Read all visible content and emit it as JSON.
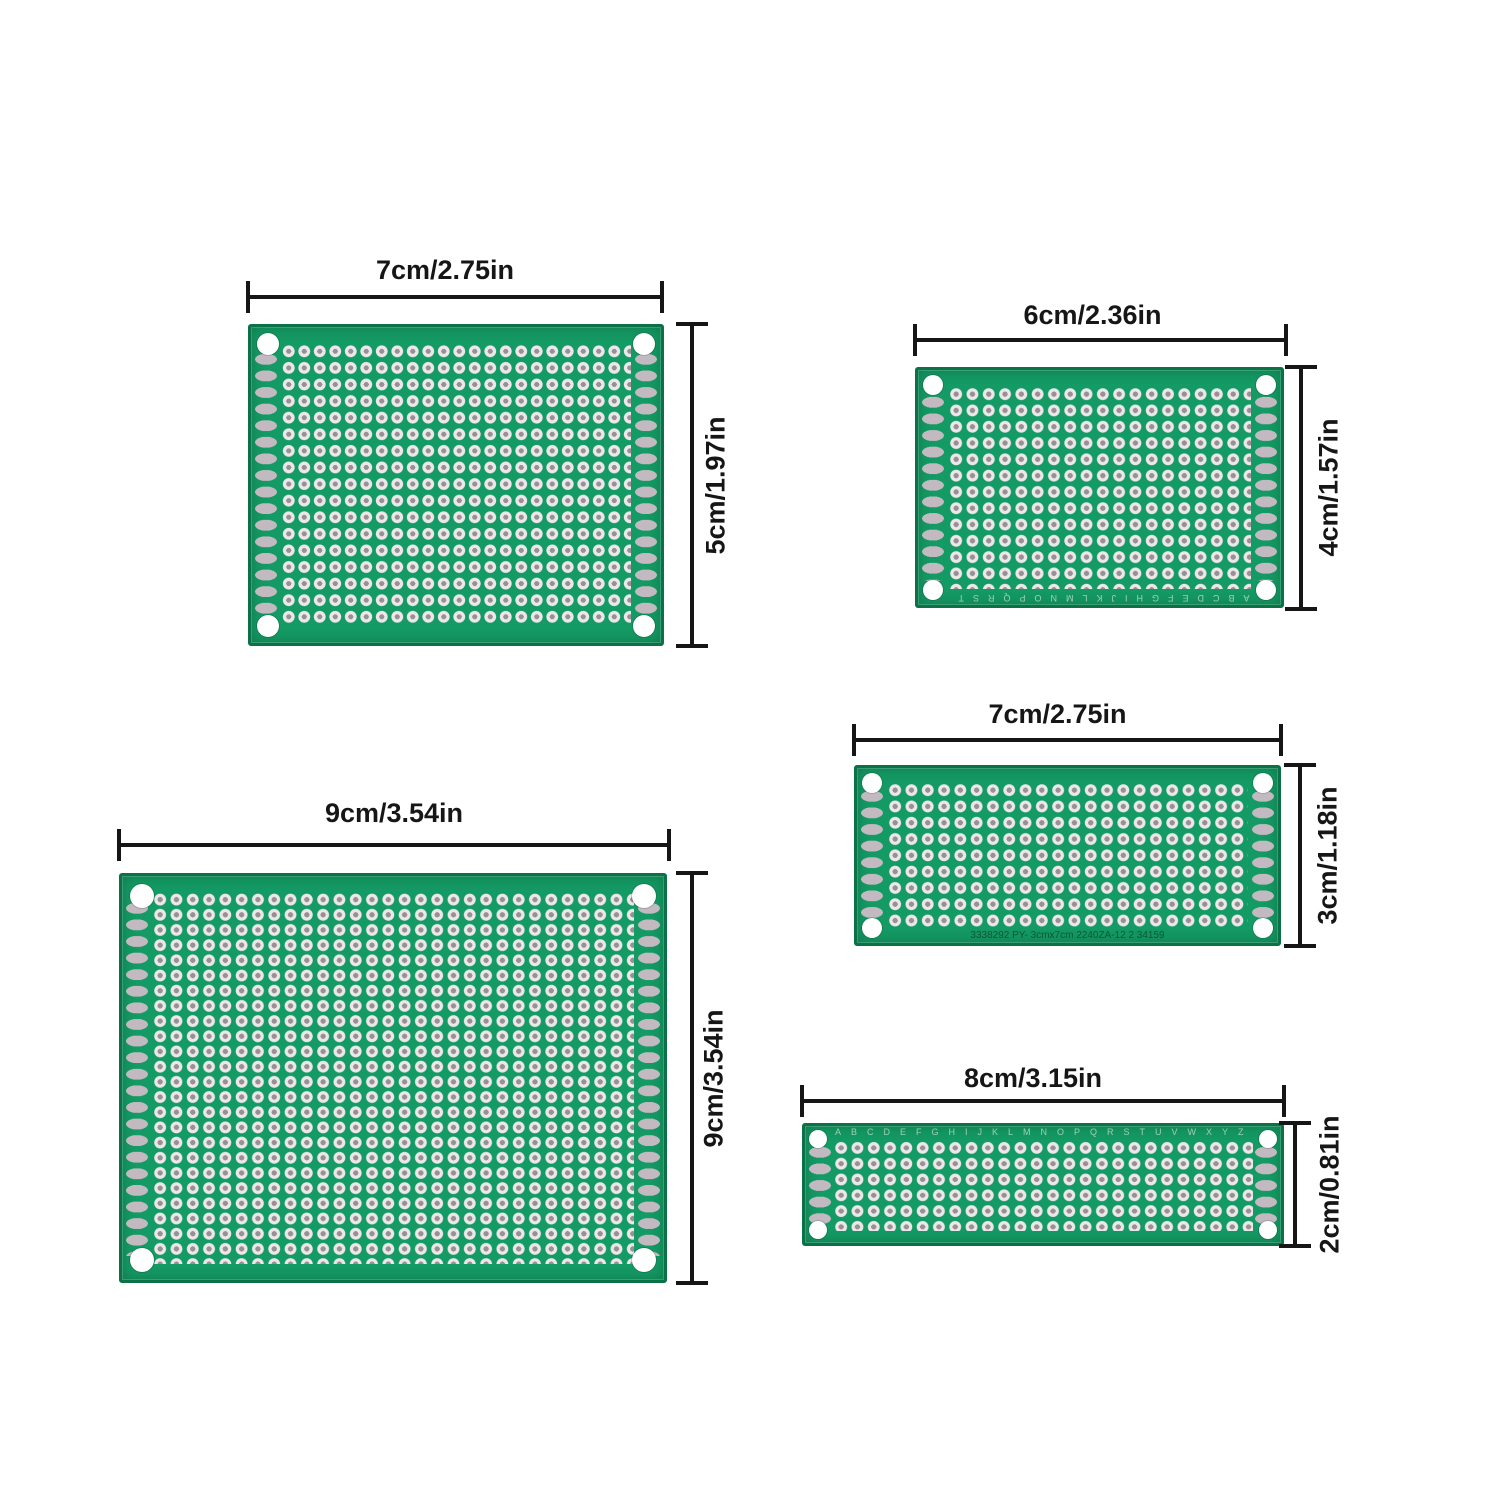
{
  "background": "#ffffff",
  "colors": {
    "pcb_green": "#149a64",
    "pcb_border_green": "#0b7248",
    "pad_ring": "#ece8ea",
    "pad_hole": "#998f94",
    "bus_pad_gray": "#c2bac0",
    "mounting_hole": "#ffffff",
    "dimension_line": "#161616"
  },
  "boards": [
    {
      "id": "7x5cm",
      "width_label": "7cm/2.75in",
      "height_label": "5cm/1.97in"
    },
    {
      "id": "6x4cm",
      "width_label": "6cm/2.36in",
      "height_label": "4cm/1.57in",
      "bottom_silkscreen": "ABCDEFGHIJKLMNOPQRST"
    },
    {
      "id": "7x3cm",
      "width_label": "7cm/2.75in",
      "height_label": "3cm/1.18in",
      "bottom_silkscreen": "3338292    PY- 3cmx7cm    2240ZA-12 2 34159"
    },
    {
      "id": "9x9cm",
      "width_label": "9cm/3.54in",
      "height_label": "9cm/3.54in"
    },
    {
      "id": "8x2cm",
      "width_label": "8cm/3.15in",
      "height_label": "2cm/0.81in",
      "top_silkscreen": "ABCDEFGHIJKLMNOPQRSTUVWXYZ"
    }
  ]
}
